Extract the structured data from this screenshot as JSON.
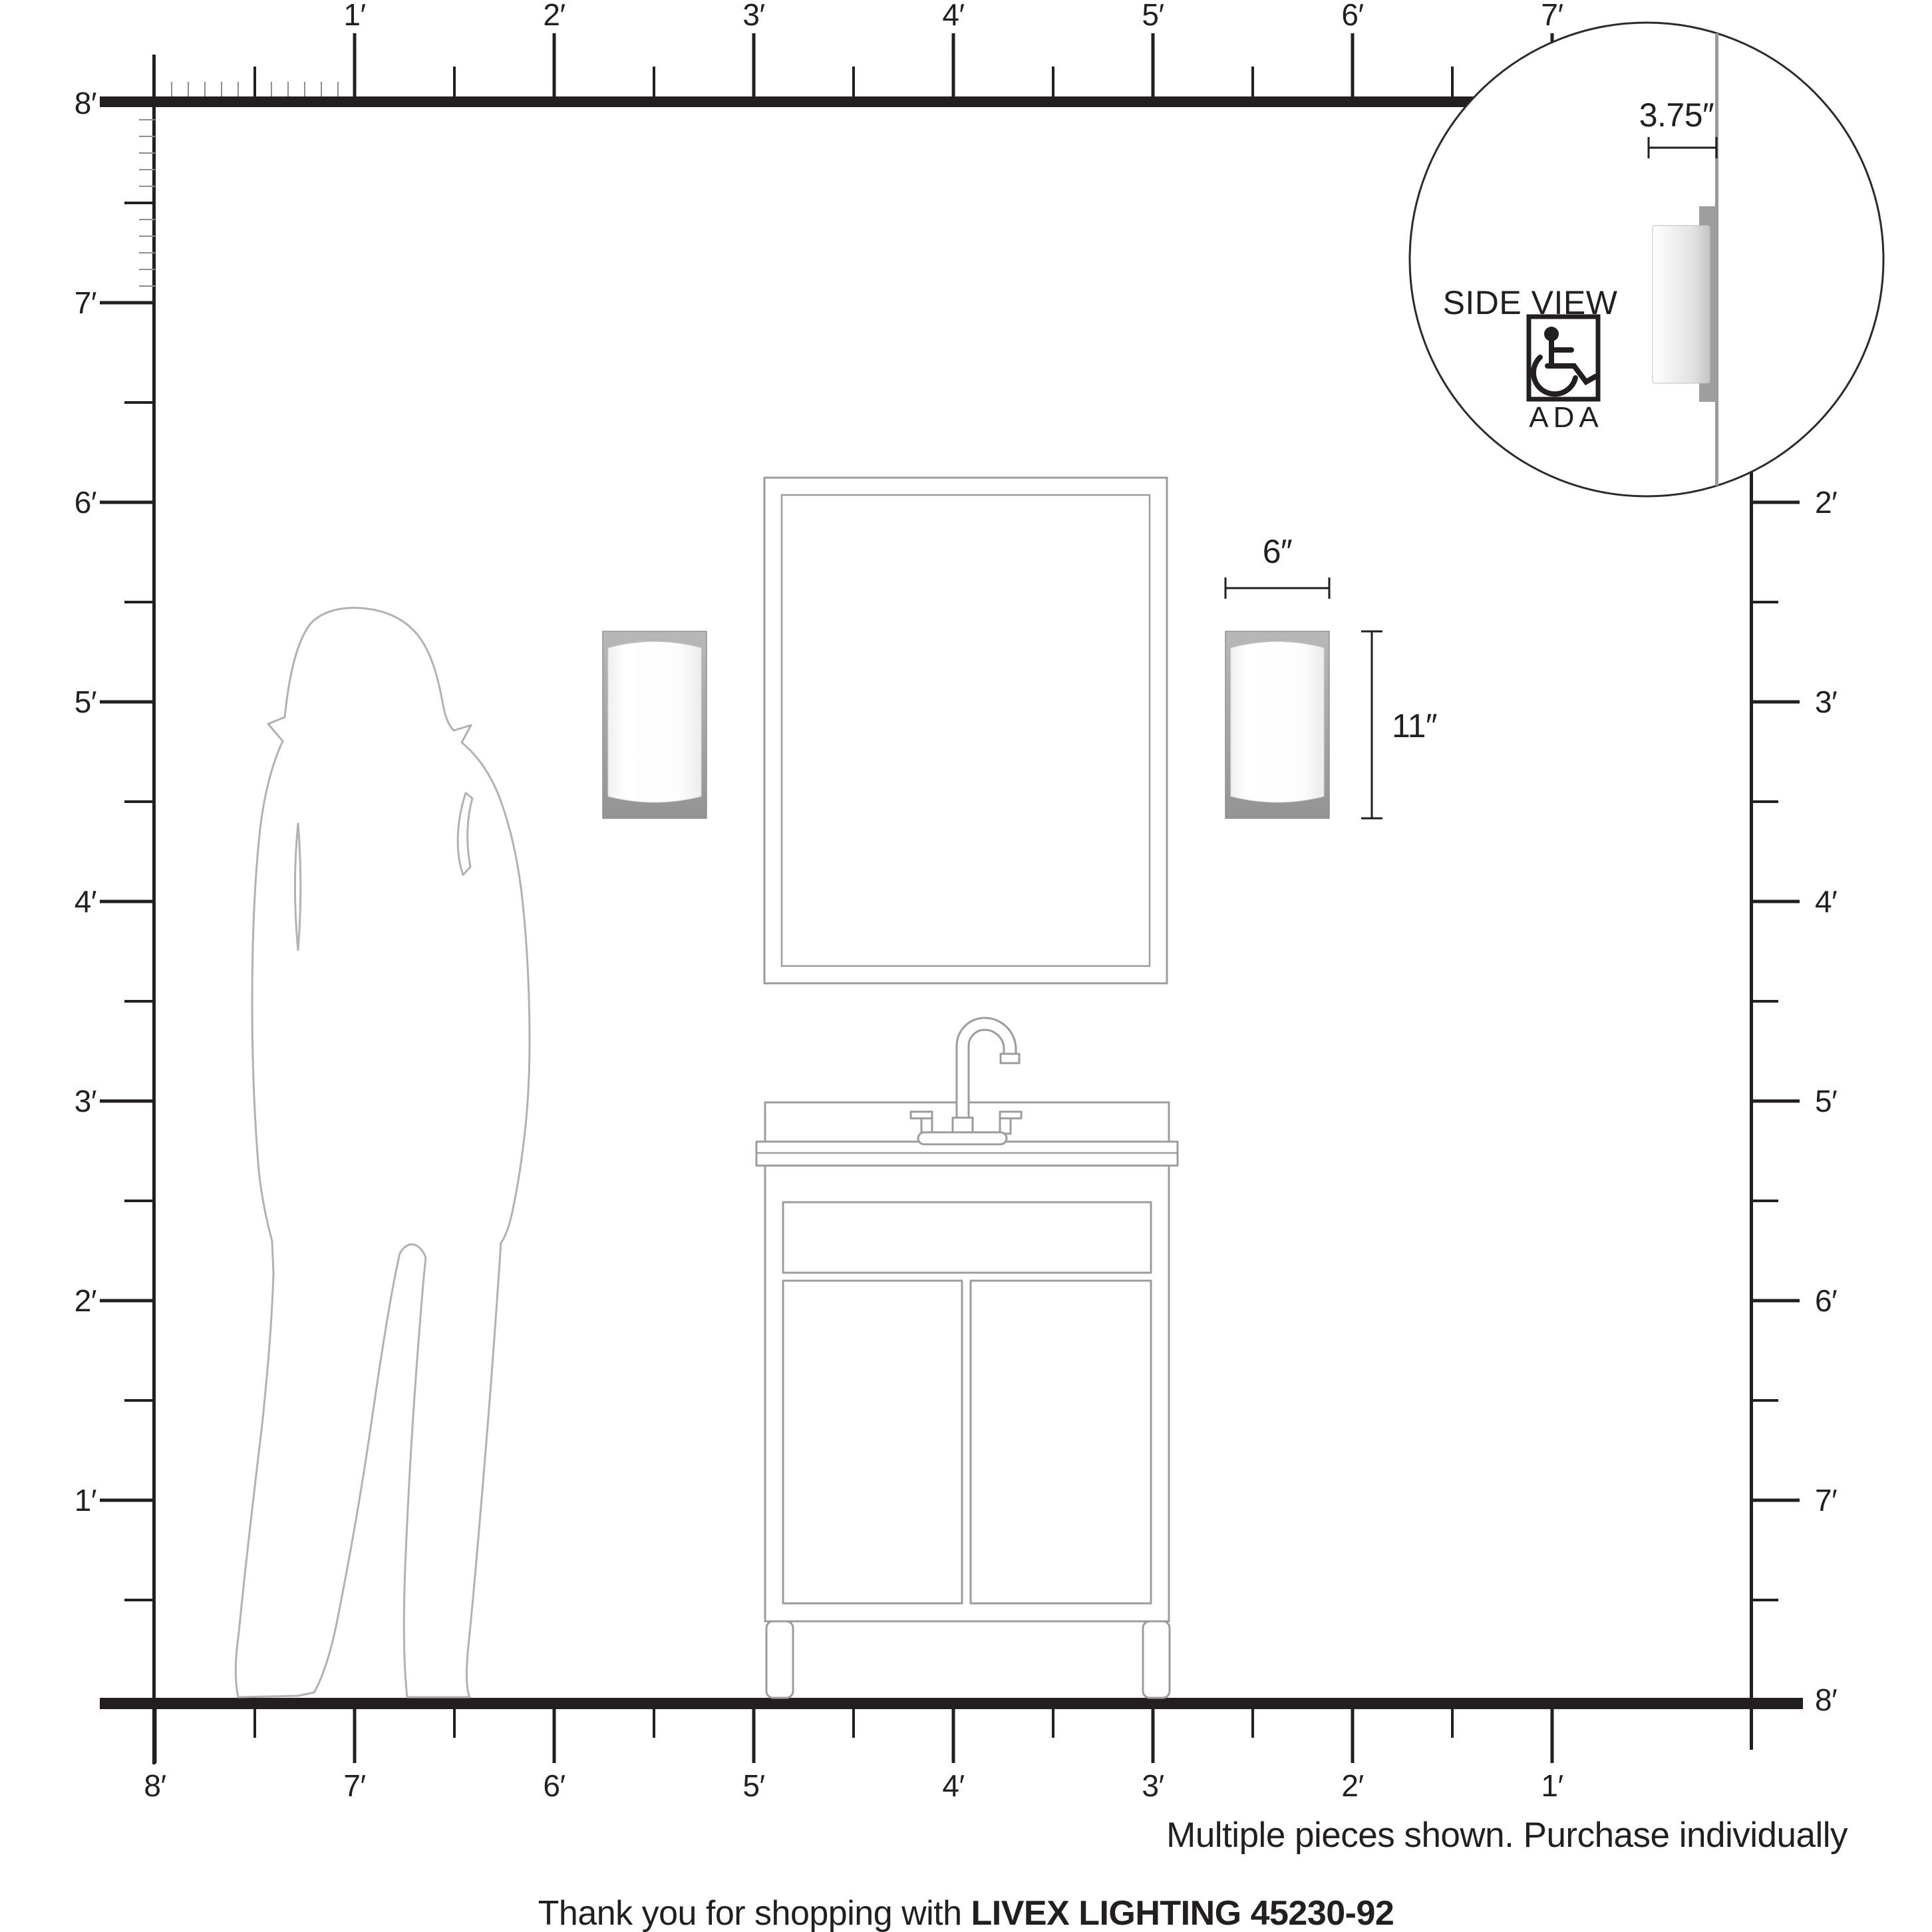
{
  "title": "Livex Lighting wall sconce scale diagram",
  "colors": {
    "ink": "#231f20",
    "outline_gray": "#9c9c9c",
    "figure_gray": "#b2b2b2",
    "tick_minor_gray": "#8f8f8f",
    "wall_line_gray": "#9a9a9a",
    "backplate_gray_top": "#b8b8b8",
    "backplate_gray_bottom": "#939393"
  },
  "rulers": {
    "top": [
      "1′",
      "2′",
      "3′",
      "4′",
      "5′",
      "6′",
      "7′"
    ],
    "left": [
      "8′",
      "7′",
      "6′",
      "5′",
      "4′",
      "3′",
      "2′",
      "1′"
    ],
    "right": [
      "2′",
      "3′",
      "4′",
      "5′",
      "6′",
      "7′",
      "8′"
    ],
    "bottom": [
      "8′",
      "7′",
      "6′",
      "5′",
      "4′",
      "3′",
      "2′",
      "1′"
    ]
  },
  "dimensions": {
    "width": "6″",
    "height": "11″",
    "depth": "3.75″"
  },
  "inset": {
    "title": "SIDE VIEW",
    "badge": "ADA"
  },
  "footer": {
    "note": "Multiple pieces shown. Purchase individually",
    "thanks": "Thank you for shopping with ",
    "brand": "LIVEX LIGHTING 45230-92"
  }
}
